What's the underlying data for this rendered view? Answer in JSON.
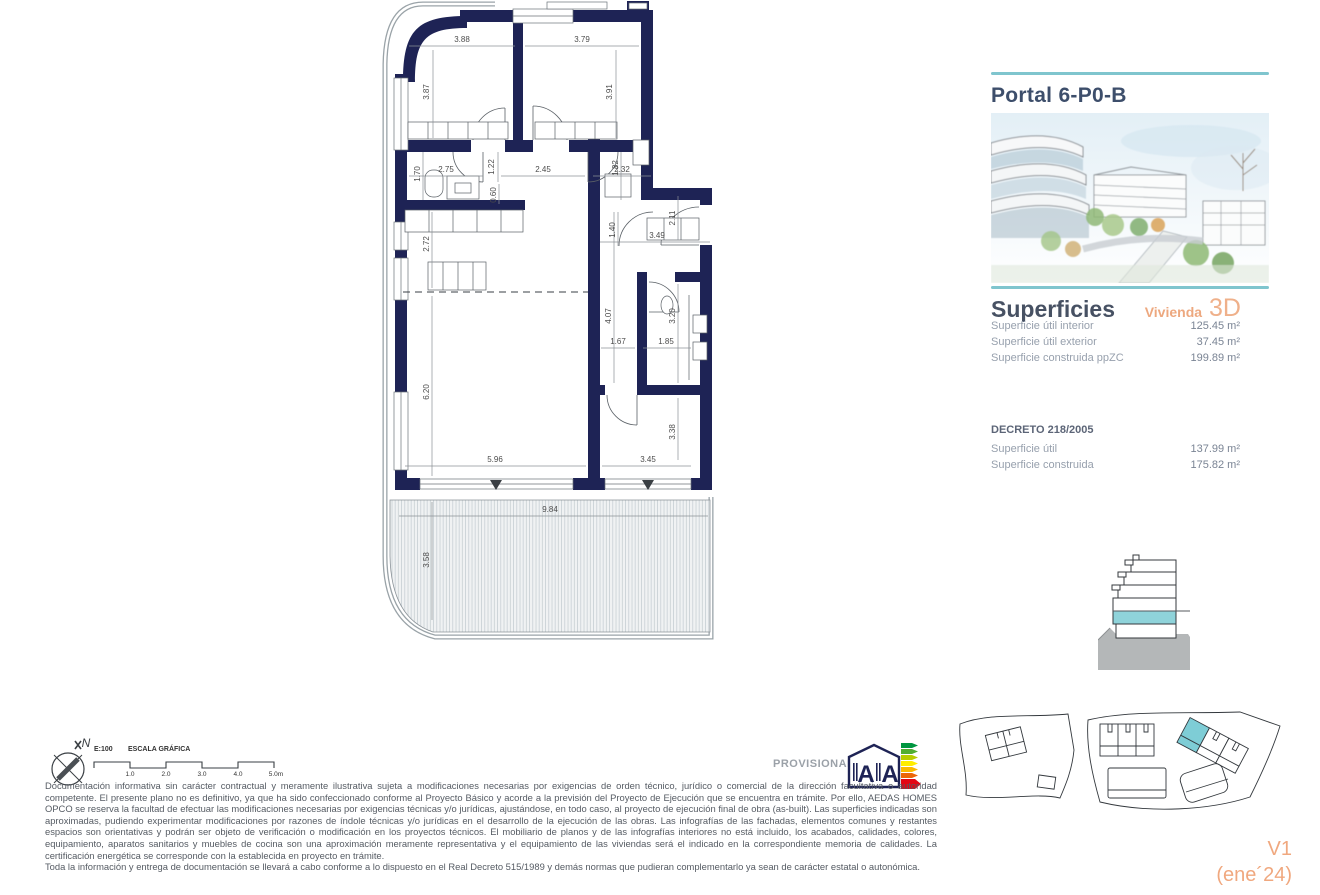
{
  "panel": {
    "portal_title": "Portal 6-P0-B",
    "superficies_title": "Superficies",
    "vivienda_label": "Vivienda",
    "vivienda_value": "3D",
    "rows": [
      {
        "label": "Superficie útil interior",
        "value": "125.45 m²"
      },
      {
        "label": "Superficie útil exterior",
        "value": "37.45 m²"
      },
      {
        "label": "Superficie construida ppZC",
        "value": "199.89 m²"
      }
    ],
    "decreto_title": "DECRETO 218/2005",
    "decreto_rows": [
      {
        "label": "Superficie útil",
        "value": "137.99 m²"
      },
      {
        "label": "Superficie construida",
        "value": "175.82 m²"
      }
    ],
    "version_line1": "V1",
    "version_line2": "(ene´24)"
  },
  "plan": {
    "dims": {
      "bed1_w": "3.88",
      "bed2_w": "3.79",
      "bed1_h": "3.87",
      "bed2_h": "3.91",
      "bath1_w": "2.75",
      "bath1_h": "1.70",
      "corr1_w": "1.22",
      "corr2_w": "2.45",
      "bath2_w": "2.32",
      "bath2_h": "1.82",
      "sink_w": "0.60",
      "kitchen_d": "2.72",
      "entry_w": "1.40",
      "entry_d": "3.49",
      "entry_h": "2.11",
      "hall_d": "4.07",
      "hall_w": "1.67",
      "bath3_d": "3.20",
      "bath3_w": "1.85",
      "living_d": "6.20",
      "living_w": "5.96",
      "bed3_w": "3.45",
      "bed3_d": "3.38",
      "terrace_w": "9.84",
      "terrace_d": "3.58"
    }
  },
  "footer": {
    "compass_letter": "N",
    "scale_ratio": "E:100",
    "scale_title": "ESCALA GRÁFICA",
    "scale_ticks": [
      "1.0",
      "2.0",
      "3.0",
      "4.0",
      "5.0m"
    ],
    "provisional": "PROVISIONAL",
    "energy_letters": [
      "A",
      "A"
    ],
    "disclaimer_p1": "Documentación informativa sin carácter contractual y meramente ilustrativa sujeta a modificaciones necesarias por exigencias de orden técnico, jurídico o comercial de la dirección facultativa o autoridad competente. El presente plano no es definitivo, ya que ha sido confeccionado conforme al Proyecto Básico y acorde a la previsión del Proyecto de Ejecución que se encuentra en trámite. Por ello, AEDAS HOMES OPCO se reserva la facultad de efectuar las modificaciones necesarias por exigencias técnicas y/o jurídicas, ajustándose, en todo caso, al proyecto de ejecución final de obra (as-built). Las superficies indicadas son aproximadas, pudiendo experimentar modificaciones por razones de índole técnicas y/o jurídicas en el desarrollo de la ejecución de las obras. Las infografías de las fachadas, elementos comunes y restantes espacios son orientativas y podrán ser objeto de verificación o modificación en los proyectos técnicos. El mobiliario de planos y de las infografías interiores no está incluido, los acabados, calidades, colores, equipamiento, aparatos sanitarios y muebles de cocina son una aproximación meramente representativa y el equipamiento de las viviendas será el indicado en la correspondiente memoria de calidades. La certificación energética se corresponde con la establecida en proyecto en trámite.",
    "disclaimer_p2": "Toda la información y entrega de documentación se llevará a cabo conforme a lo dispuesto en el Real Decreto 515/1989 y demás normas que pudieran complementarlo ya sean de carácter estatal o autonómica."
  },
  "colors": {
    "wall_navy": "#1e2355",
    "accent_teal": "#7fc5ce",
    "accent_orange": "#eda87f",
    "title_slate": "#3d4e6b"
  }
}
